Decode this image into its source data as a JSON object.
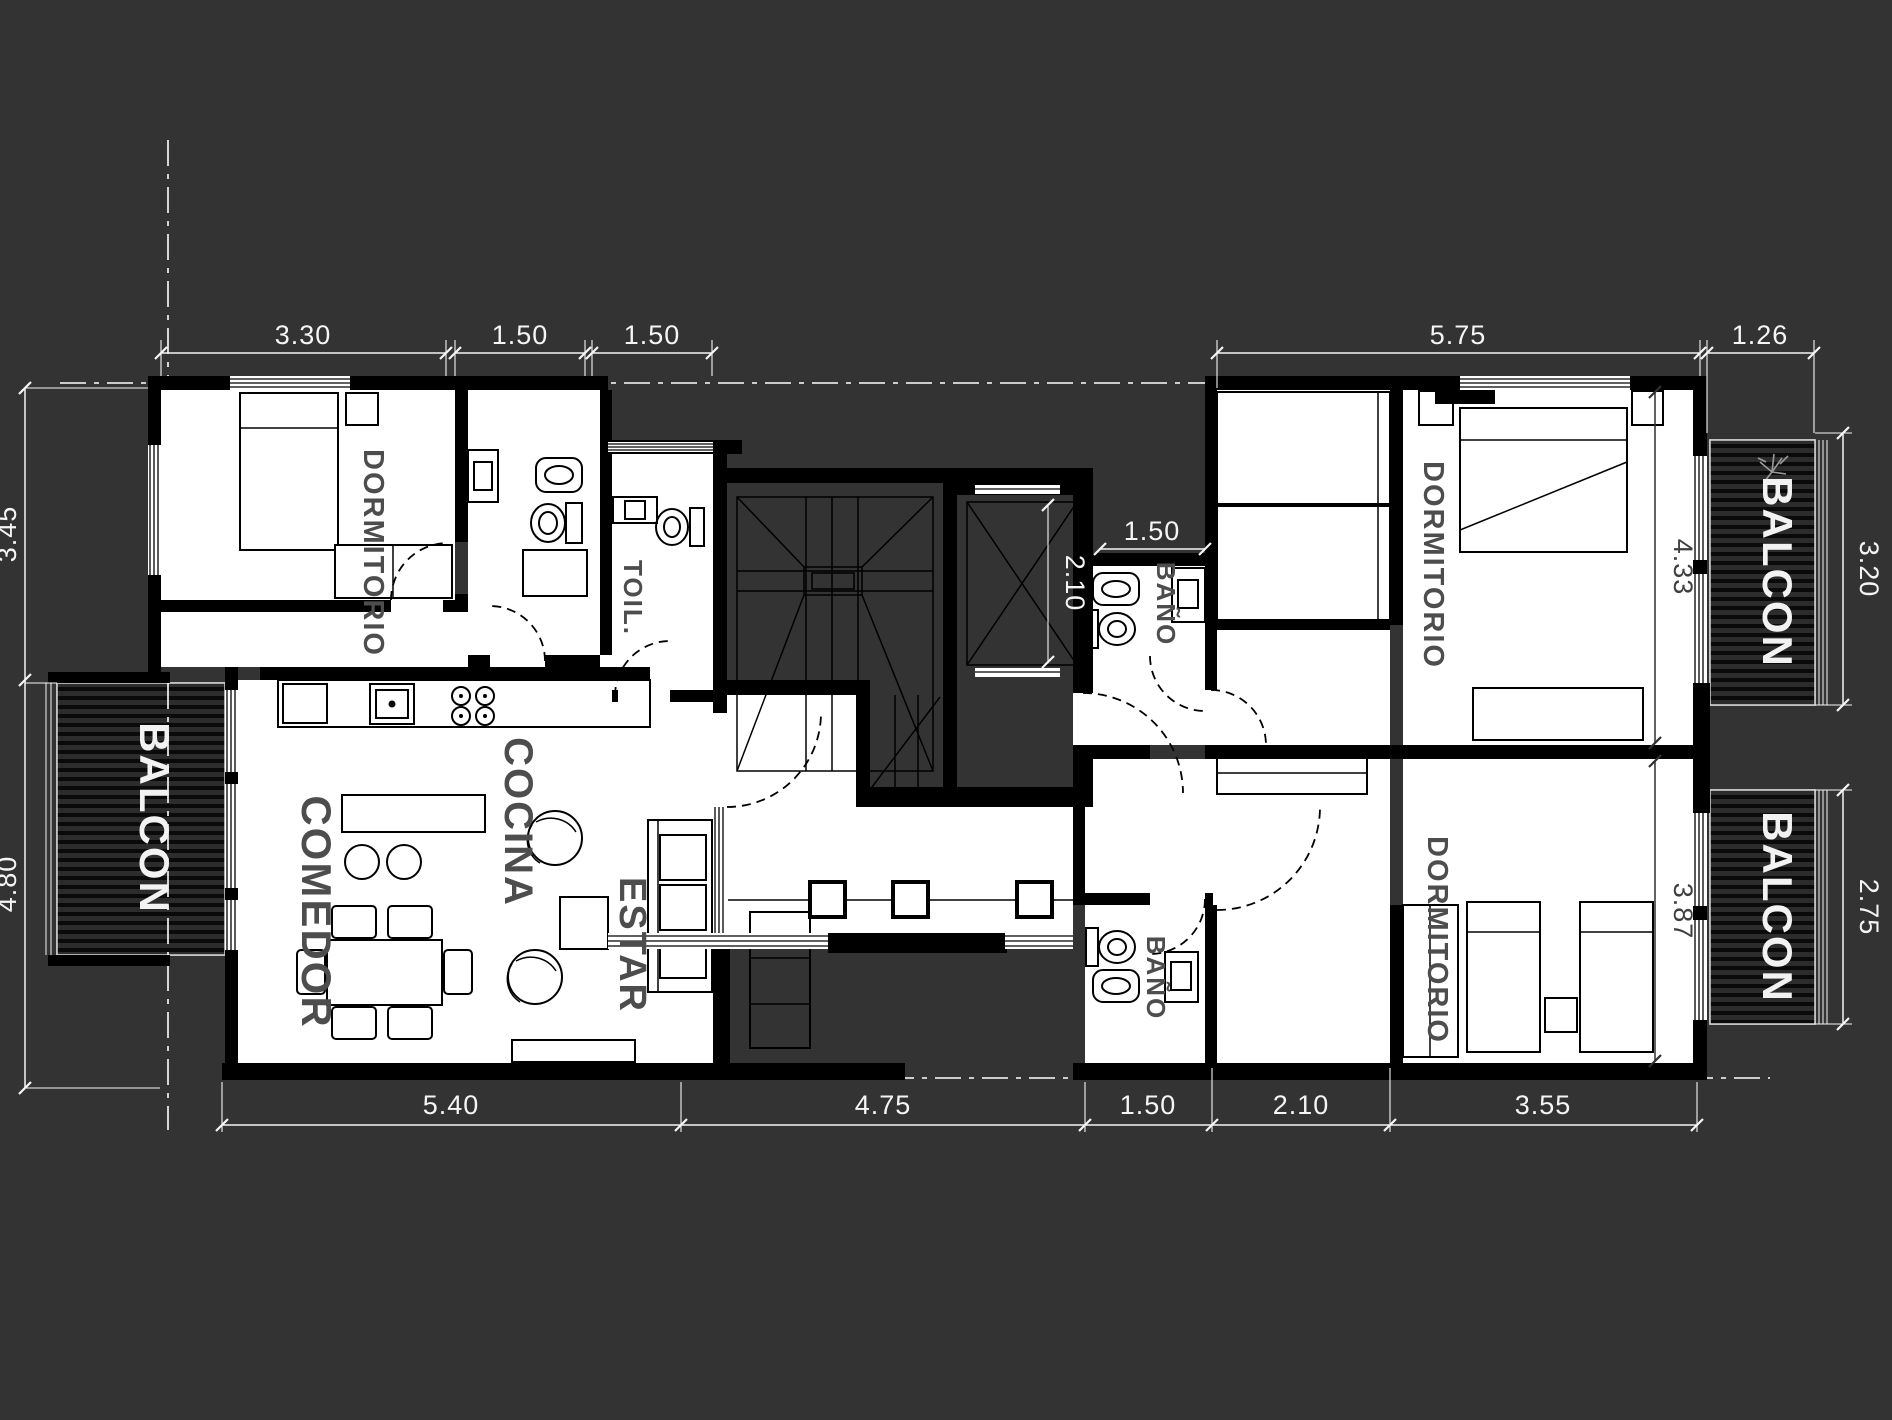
{
  "drawing": {
    "type": "apartment-floor-plan",
    "colors": {
      "background": "#333333",
      "walls": "#000000",
      "floor": "#ffffff",
      "room_label": "#4d4d4d",
      "dimension_text": "#f5f5f5",
      "balcony_stripe": "#0a0a0a"
    }
  },
  "rooms": [
    {
      "id": "bedroom-top-left",
      "label": "DORMITORIO"
    },
    {
      "id": "toilette",
      "label": "TOIL."
    },
    {
      "id": "kitchen",
      "label": "COCINA"
    },
    {
      "id": "dining",
      "label": "COMEDOR"
    },
    {
      "id": "living",
      "label": "ESTAR"
    },
    {
      "id": "bath-upper-right",
      "label": "BAÑO"
    },
    {
      "id": "bedroom-top-right",
      "label": "DORMITORIO"
    },
    {
      "id": "bath-lower-right",
      "label": "BAÑO"
    },
    {
      "id": "bedroom-bottom-right",
      "label": "DORMITORIO"
    },
    {
      "id": "balcony-left",
      "label": "BALCON"
    },
    {
      "id": "balcony-top-right",
      "label": "BALCON"
    },
    {
      "id": "balcony-bottom-right",
      "label": "BALCON"
    }
  ],
  "dimensions": {
    "top": [
      "3.30",
      "1.50",
      "1.50",
      "5.75",
      "1.26"
    ],
    "bottom": [
      "5.40",
      "4.75",
      "1.50",
      "2.10",
      "3.55"
    ],
    "left": [
      "3.45",
      "4.80"
    ],
    "right": [
      "3.20",
      "2.75"
    ],
    "interior": {
      "elevator_depth": "2.10",
      "bath_upper_width": "1.50",
      "bedroom_top_right_depth": "4.33",
      "bedroom_bottom_right_depth": "3.87"
    }
  }
}
